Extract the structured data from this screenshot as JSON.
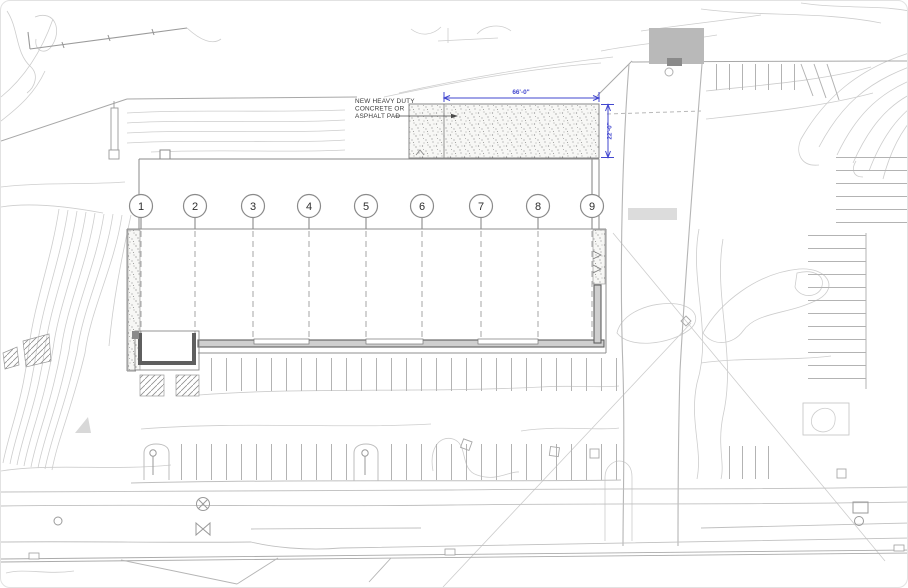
{
  "annotations": {
    "pad_label_line1": "NEW HEAVY DUTY",
    "pad_label_line2": "CONCRETE OR",
    "pad_label_line3": "ASPHALT PAD",
    "pad_width_dim": "66'-0\"",
    "pad_depth_dim": "22'-0\""
  },
  "grid_bubbles": [
    "1",
    "2",
    "3",
    "4",
    "5",
    "6",
    "7",
    "8",
    "9"
  ],
  "colors": {
    "dimension_blue": "#4247cf",
    "contour_light": "#cdcdcd",
    "contour_medium": "#b0b0b0",
    "drawing_dark": "#8a8a8a",
    "wall_dark": "#5f5f5f",
    "dumpster_pad_gray": "#b9b9b9",
    "crosswalk_gray": "#dcdcdc",
    "label_text": "#3a3a3a"
  }
}
